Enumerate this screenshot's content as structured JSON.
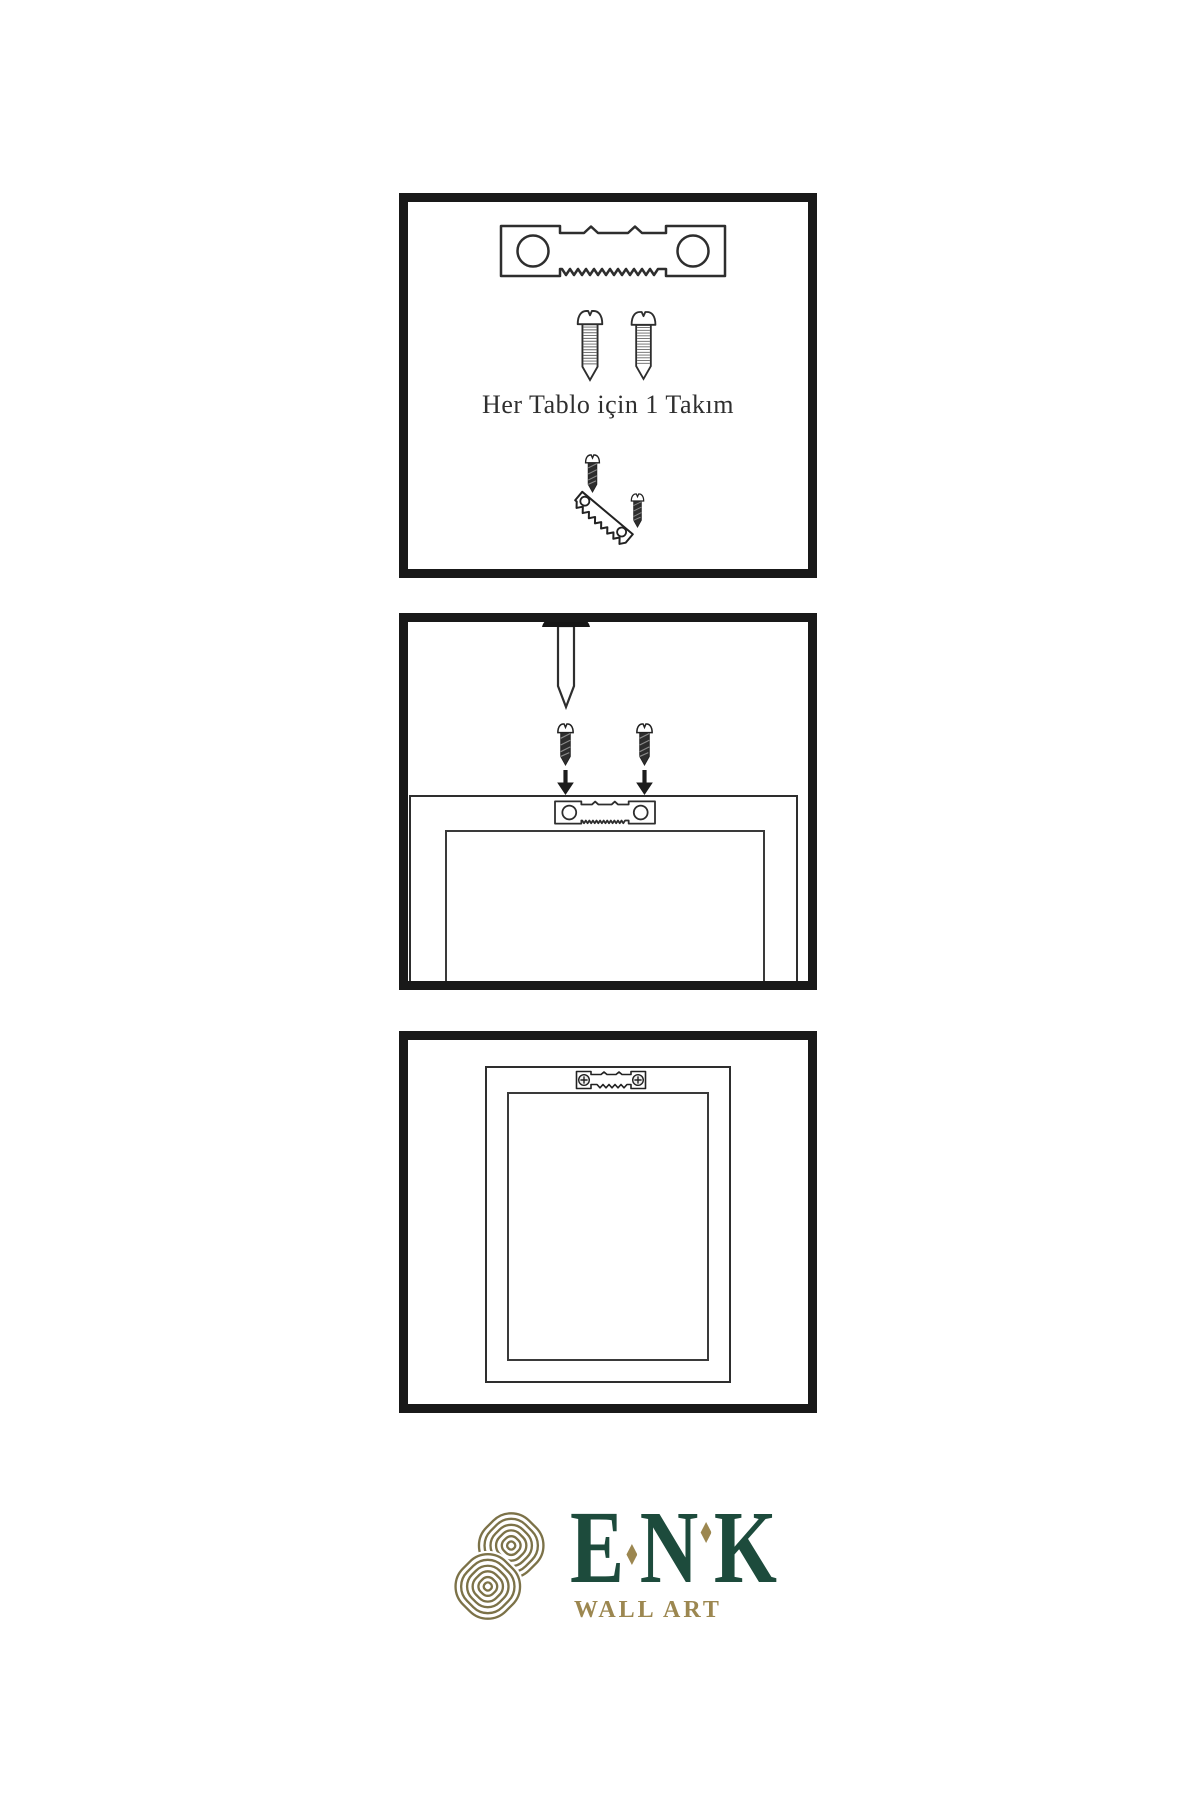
{
  "sheet": {
    "background": "#ffffff",
    "line_color": "#2e2e2e",
    "panel_border_color": "#191919"
  },
  "instructions": {
    "step1": {
      "caption": "Her Tablo için 1 Takım",
      "parts": [
        "sawtooth-hanger",
        "screw",
        "screw",
        "screw-into-sawtooth-hanger-example"
      ]
    },
    "step2": {
      "parts": [
        "wall-nail",
        "screw",
        "screw",
        "down-arrow",
        "down-arrow",
        "frame-back",
        "sawtooth-hanger"
      ]
    },
    "step3": {
      "parts": [
        "frame-back",
        "installed-sawtooth-hanger"
      ]
    }
  },
  "logo": {
    "brand": "ENK",
    "brand_letters": [
      "E",
      "N",
      "K"
    ],
    "subtitle": "WALL ART",
    "colors": {
      "brand_green": "#1d4b3c",
      "accent_gold": "#9c8750",
      "knot_olive": "#7c7248"
    }
  }
}
